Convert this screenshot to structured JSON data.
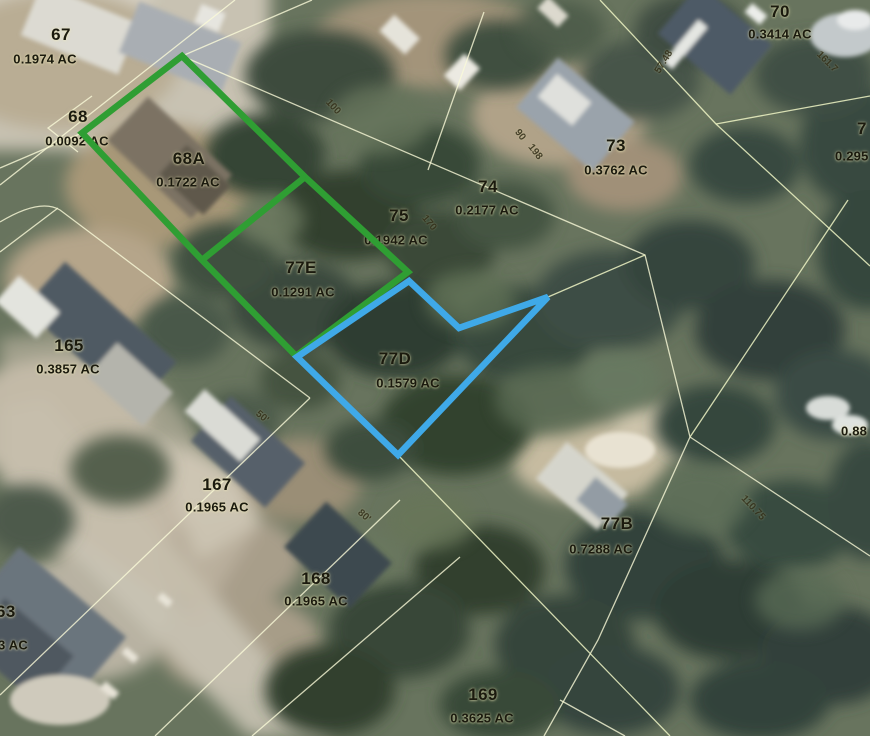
{
  "map_type": "parcel-aerial-map",
  "colors": {
    "highlight_green": "#2f9e33",
    "highlight_blue": "#3fa9e8",
    "parcel_line": "#f5f5d8",
    "label_text": "#1b1a0e"
  },
  "parcels": [
    {
      "number": "67",
      "acreage": "0.1974 AC"
    },
    {
      "number": "68",
      "acreage": "0.0092 AC"
    },
    {
      "number": "68A",
      "acreage": "0.1722 AC"
    },
    {
      "number": "70",
      "acreage": "0.3414 AC"
    },
    {
      "number": "73",
      "acreage": "0.3762 AC"
    },
    {
      "number": "74",
      "acreage": "0.2177 AC"
    },
    {
      "number": "75",
      "acreage": "0.1942 AC"
    },
    {
      "number": "77E",
      "acreage": "0.1291 AC"
    },
    {
      "number": "77D",
      "acreage": "0.1579 AC"
    },
    {
      "number": "165",
      "acreage": "0.3857 AC"
    },
    {
      "number": "167",
      "acreage": "0.1965 AC"
    },
    {
      "number": "77B",
      "acreage": "0.7288 AC"
    },
    {
      "number": "168",
      "acreage": "0.1965 AC"
    },
    {
      "number": "169",
      "acreage": "0.3625 AC"
    }
  ],
  "edge_labels": [
    {
      "text": "7"
    },
    {
      "text": "0.295"
    },
    {
      "text": "0.88"
    },
    {
      "text": "63"
    },
    {
      "text": "3 AC"
    }
  ],
  "dimension_labels": [
    {
      "text": "100"
    },
    {
      "text": "170"
    },
    {
      "text": "90"
    },
    {
      "text": "198"
    },
    {
      "text": "50'"
    },
    {
      "text": "80'"
    },
    {
      "text": "57.48"
    },
    {
      "text": "110.75"
    },
    {
      "text": "161.7"
    }
  ]
}
